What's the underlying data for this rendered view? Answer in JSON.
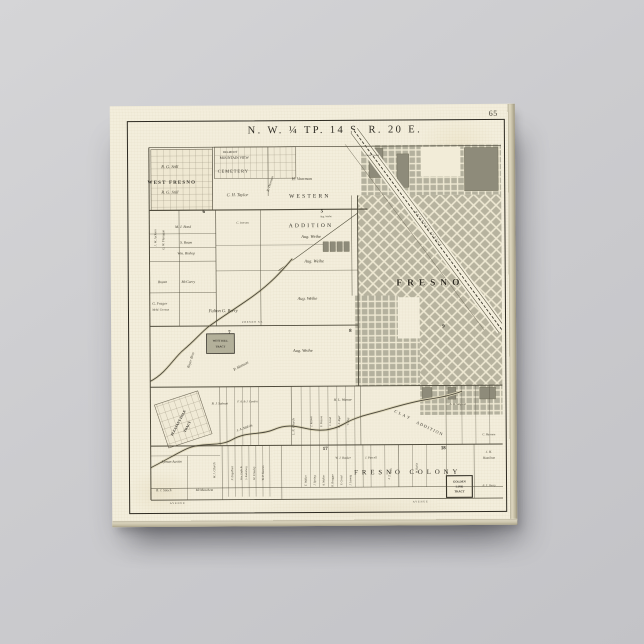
{
  "scene": {
    "background": "#cbcbce",
    "description": "Gallery-wrapped canvas print of an antique plat map of Fresno township hanging on a gray wall"
  },
  "canvas": {
    "page_number": "65"
  },
  "map": {
    "title": "N. W. ¼ TP. 14 S. R. 20 E.",
    "ink": "#35322a",
    "paper": "#f2ecd8",
    "block_fill": "#b7b4a2",
    "city_name": "FRESNO",
    "labels": [
      {
        "t": "WEST FRESNO",
        "x": 41,
        "y": 61,
        "s": 5,
        "ls": 1.2,
        "c": "b"
      },
      {
        "t": "R. G. Still",
        "x": 39,
        "y": 45,
        "s": 4.4,
        "c": "i"
      },
      {
        "t": "R. G. Still",
        "x": 39,
        "y": 71,
        "s": 4.4,
        "c": "i"
      },
      {
        "t": "BELMONT",
        "x": 100,
        "y": 30,
        "s": 3
      },
      {
        "t": "MOUNTAIN VIEW",
        "x": 104,
        "y": 36,
        "s": 3.6
      },
      {
        "t": "CEMETERY",
        "x": 103,
        "y": 50,
        "s": 4.4,
        "ls": 1
      },
      {
        "t": "C. H. Taylor",
        "x": 107,
        "y": 74,
        "s": 4.4,
        "c": "i"
      },
      {
        "t": "H. Voorman",
        "x": 172,
        "y": 58,
        "s": 4.2,
        "c": "i"
      },
      {
        "t": "R. Thurman",
        "x": 141,
        "y": 62,
        "s": 3.4,
        "r": -72,
        "c": "i"
      },
      {
        "t": "WESTERN",
        "x": 180,
        "y": 76,
        "s": 5.6,
        "ls": 2.2
      },
      {
        "t": "ADDITION",
        "x": 181,
        "y": 106,
        "s": 5.6,
        "ls": 2.2
      },
      {
        "t": "Aug. Weihe",
        "x": 181,
        "y": 117,
        "s": 4.4,
        "c": "i"
      },
      {
        "t": "Aug. Weihe",
        "x": 184,
        "y": 142,
        "s": 4.4,
        "c": "i"
      },
      {
        "t": "Aug. Weihe",
        "x": 177,
        "y": 180,
        "s": 4.4,
        "c": "i"
      },
      {
        "t": "Aug. Weihe",
        "x": 172,
        "y": 233,
        "s": 4.4,
        "c": "i"
      },
      {
        "t": "Aug. Weihe",
        "x": 196,
        "y": 96,
        "s": 2.6,
        "c": "i"
      },
      {
        "t": "FRESNO",
        "x": 301,
        "y": 166,
        "s": 9.5,
        "ls": 5,
        "c": "city"
      },
      {
        "t": "Grand Central",
        "x": 243,
        "y": 34,
        "s": 2.5
      },
      {
        "t": "M. J. Bond",
        "x": 52,
        "y": 106,
        "s": 3.7,
        "c": "i"
      },
      {
        "t": "S. Beam",
        "x": 55,
        "y": 122,
        "s": 3.7,
        "c": "i"
      },
      {
        "t": "Wm. Bishop",
        "x": 55,
        "y": 133,
        "s": 3.7,
        "c": "i"
      },
      {
        "t": "J. W. Jackson",
        "x": 25,
        "y": 116,
        "s": 3.2,
        "r": -90,
        "c": "i"
      },
      {
        "t": "G. W. Flanagan",
        "x": 33,
        "y": 118,
        "s": 3.2,
        "r": -90,
        "c": "i"
      },
      {
        "t": "C. Iversen",
        "x": 112,
        "y": 102,
        "s": 3,
        "c": "i"
      },
      {
        "t": "Royan",
        "x": 31,
        "y": 162,
        "s": 3.7,
        "c": "i"
      },
      {
        "t": "McGarry",
        "x": 57,
        "y": 162,
        "s": 3.7,
        "c": "i"
      },
      {
        "t": "G. Frager",
        "x": 28,
        "y": 184,
        "s": 3.7,
        "c": "i"
      },
      {
        "t": "McM. Corman",
        "x": 29,
        "y": 190,
        "s": 2.9,
        "c": "i"
      },
      {
        "t": "Fulton G. Berry",
        "x": 92,
        "y": 192,
        "s": 4.6,
        "c": "i"
      },
      {
        "t": "Royer Bros",
        "x": 60,
        "y": 241,
        "s": 3.7,
        "r": -72,
        "c": "i"
      },
      {
        "t": "P. Monson",
        "x": 110,
        "y": 248,
        "s": 4,
        "r": -28,
        "c": "i"
      },
      {
        "t": "WEST HILL",
        "x": 89,
        "y": 222,
        "s": 2.8,
        "c": "b"
      },
      {
        "t": "TRACT",
        "x": 89,
        "y": 228,
        "s": 2.8,
        "c": "b"
      },
      {
        "t": "FRESNO ST.",
        "x": 122,
        "y": 203,
        "s": 2.6,
        "ls": 0.8
      },
      {
        "t": "PLEASANT DALE",
        "x": 47,
        "y": 305,
        "s": 3.5,
        "r": -62,
        "c": "b"
      },
      {
        "t": "TRACT",
        "x": 56,
        "y": 309,
        "s": 3.5,
        "r": -62,
        "c": "b"
      },
      {
        "t": "B. J. Salmon",
        "x": 88,
        "y": 286,
        "s": 3.3,
        "c": "i"
      },
      {
        "t": "F. A. & J. Condra",
        "x": 116,
        "y": 284,
        "s": 2.9,
        "c": "i"
      },
      {
        "t": "J. A. Malvin",
        "x": 113,
        "y": 311,
        "s": 3.5,
        "r": -20,
        "c": "i"
      },
      {
        "t": "L. N. Church",
        "x": 163,
        "y": 309,
        "s": 3.3,
        "r": -90,
        "c": "i"
      },
      {
        "t": "Lyman Austin",
        "x": 39,
        "y": 345,
        "s": 3.7,
        "c": "i"
      },
      {
        "t": "B. J. Stioch",
        "x": 31,
        "y": 374,
        "s": 3.4,
        "c": "i"
      },
      {
        "t": "McMeachem",
        "x": 72,
        "y": 374,
        "s": 3.4,
        "c": "i"
      },
      {
        "t": "W. J. Church",
        "x": 83,
        "y": 353,
        "s": 3.2,
        "r": -90,
        "c": "i"
      },
      {
        "t": "F. Engelbert",
        "x": 101,
        "y": 356,
        "s": 3,
        "r": -90,
        "c": "i"
      },
      {
        "t": "Wm. Engle &",
        "x": 110,
        "y": 356,
        "s": 2.6,
        "r": -90,
        "c": "i"
      },
      {
        "t": "S. Rodenberg",
        "x": 115,
        "y": 356,
        "s": 2.6,
        "r": -90,
        "c": "i"
      },
      {
        "t": "H. Crowley",
        "x": 123,
        "y": 356,
        "s": 3,
        "r": -90,
        "c": "i"
      },
      {
        "t": "W. P. Kearns",
        "x": 132,
        "y": 356,
        "s": 3,
        "r": -90,
        "c": "i"
      },
      {
        "t": "H. L. Warner",
        "x": 212,
        "y": 283,
        "s": 3.5,
        "c": "i"
      },
      {
        "t": "J. Keown",
        "x": 181,
        "y": 304,
        "s": 2.9,
        "r": -90,
        "c": "i"
      },
      {
        "t": "F. Pascoe",
        "x": 191,
        "y": 304,
        "s": 2.9,
        "r": -90,
        "c": "i"
      },
      {
        "t": "J. Lovel",
        "x": 200,
        "y": 304,
        "s": 2.9,
        "r": -90,
        "c": "i"
      },
      {
        "t": "B. F. Alger",
        "x": 209,
        "y": 304,
        "s": 2.9,
        "r": -90,
        "c": "i"
      },
      {
        "t": "V. Clay",
        "x": 218,
        "y": 304,
        "s": 2.9,
        "r": -90,
        "c": "i"
      },
      {
        "t": "CLAY",
        "x": 272,
        "y": 299,
        "s": 4.2,
        "r": 26,
        "ls": 2
      },
      {
        "t": "ADDITION",
        "x": 299,
        "y": 313,
        "s": 4.2,
        "r": 26,
        "ls": 1.2
      },
      {
        "t": "A. H. Simpson",
        "x": 328,
        "y": 288,
        "s": 2.9,
        "c": "i"
      },
      {
        "t": "C. Harmon",
        "x": 359,
        "y": 319,
        "s": 2.9,
        "c": "i"
      },
      {
        "t": "FRESNO COLONY",
        "x": 277,
        "y": 358,
        "s": 6.8,
        "ls": 4.5,
        "c": "colony"
      },
      {
        "t": "J. H.",
        "x": 359,
        "y": 337,
        "s": 3.3,
        "c": "i"
      },
      {
        "t": "Hamilton",
        "x": 359,
        "y": 343,
        "s": 3.3,
        "c": "i"
      },
      {
        "t": "GOLDEN",
        "x": 329,
        "y": 367,
        "s": 3,
        "c": "b"
      },
      {
        "t": "LINK",
        "x": 329,
        "y": 372,
        "s": 3,
        "c": "b"
      },
      {
        "t": "TRACT",
        "x": 329,
        "y": 377,
        "s": 3,
        "c": "b"
      },
      {
        "t": "B. S. Derry",
        "x": 359,
        "y": 371,
        "s": 3,
        "c": "i"
      },
      {
        "t": "T. Walker",
        "x": 175,
        "y": 364,
        "s": 2.9,
        "r": -90,
        "c": "i"
      },
      {
        "t": "J. Spring",
        "x": 184,
        "y": 364,
        "s": 2.9,
        "r": -90,
        "c": "i"
      },
      {
        "t": "A. Walker",
        "x": 193,
        "y": 364,
        "s": 2.9,
        "r": -90,
        "c": "i"
      },
      {
        "t": "R. Bragger",
        "x": 202,
        "y": 364,
        "s": 2.9,
        "r": -90,
        "c": "i"
      },
      {
        "t": "F. Creed",
        "x": 211,
        "y": 364,
        "s": 2.9,
        "r": -90,
        "c": "i"
      },
      {
        "t": "J. Lannig",
        "x": 220,
        "y": 364,
        "s": 2.9,
        "r": -90,
        "c": "i"
      },
      {
        "t": "W. J. Booker",
        "x": 212,
        "y": 342,
        "s": 3.1,
        "c": "i"
      },
      {
        "t": "J. Purcell",
        "x": 240,
        "y": 342,
        "s": 3.1,
        "c": "i"
      },
      {
        "t": "J. T. Lyon",
        "x": 260,
        "y": 358,
        "s": 3,
        "r": -78,
        "c": "i"
      },
      {
        "t": "W. Burke",
        "x": 287,
        "y": 352,
        "s": 2.9,
        "r": -90,
        "c": "i"
      },
      {
        "t": "RAILROAD AVENUE",
        "x": 299,
        "y": 109,
        "s": 2.8,
        "r": 54,
        "ls": 1.2
      },
      {
        "t": "AVENUE",
        "x": 45,
        "y": 387,
        "s": 2.5,
        "ls": 1
      },
      {
        "t": "AVENUE",
        "x": 290,
        "y": 387,
        "s": 2.5,
        "ls": 1
      },
      {
        "t": "6",
        "x": 73,
        "y": 91,
        "s": 5,
        "c": "sec"
      },
      {
        "t": "5",
        "x": 192,
        "y": 91,
        "s": 5,
        "c": "sec"
      },
      {
        "t": "7",
        "x": 98,
        "y": 214,
        "s": 5,
        "c": "sec"
      },
      {
        "t": "8",
        "x": 220,
        "y": 213,
        "s": 5,
        "c": "sec"
      },
      {
        "t": "9",
        "x": 314,
        "y": 209,
        "s": 5,
        "c": "sec"
      },
      {
        "t": "17",
        "x": 194,
        "y": 333,
        "s": 5,
        "c": "sec"
      },
      {
        "t": "18",
        "x": 313,
        "y": 333,
        "s": 5,
        "c": "sec"
      }
    ],
    "rects": [
      {
        "x": 20,
        "y": 26,
        "w": 62,
        "h": 62,
        "c": "lots2"
      },
      {
        "x": 84,
        "y": 24,
        "w": 82,
        "h": 32,
        "c": "lots"
      },
      {
        "x": 232,
        "y": 23,
        "w": 141,
        "h": 51,
        "c": "axis"
      },
      {
        "x": 240,
        "y": 26,
        "w": 14,
        "h": 30,
        "c": "dark"
      },
      {
        "x": 268,
        "y": 32,
        "w": 12,
        "h": 34,
        "c": "dark"
      },
      {
        "x": 336,
        "y": 26,
        "w": 34,
        "h": 44,
        "c": "dark"
      },
      {
        "x": 292,
        "y": 25,
        "w": 40,
        "h": 30,
        "c": "paper"
      },
      {
        "x": 228,
        "y": 74,
        "w": 145,
        "h": 104,
        "c": "diag"
      },
      {
        "x": 290,
        "y": 178,
        "w": 83,
        "h": 90,
        "c": "diag"
      },
      {
        "x": 225,
        "y": 176,
        "w": 43,
        "h": 44,
        "c": "axis"
      },
      {
        "x": 225,
        "y": 220,
        "w": 65,
        "h": 48,
        "c": "axis"
      },
      {
        "x": 290,
        "y": 268,
        "w": 83,
        "h": 30,
        "c": "axis"
      },
      {
        "x": 292,
        "y": 270,
        "w": 10,
        "h": 12,
        "c": "dark"
      },
      {
        "x": 318,
        "y": 270,
        "w": 8,
        "h": 12,
        "c": "dark"
      },
      {
        "x": 350,
        "y": 270,
        "w": 16,
        "h": 12,
        "c": "dark"
      },
      {
        "x": 193,
        "y": 121,
        "w": 5.5,
        "h": 10,
        "c": "dark"
      },
      {
        "x": 200,
        "y": 121,
        "w": 5.5,
        "h": 10,
        "c": "dark"
      },
      {
        "x": 207,
        "y": 121,
        "w": 5.5,
        "h": 10,
        "c": "dark"
      },
      {
        "x": 214,
        "y": 121,
        "w": 5.5,
        "h": 10,
        "c": "dark"
      },
      {
        "x": 75,
        "y": 214,
        "w": 28,
        "h": 20,
        "c": "boxdark"
      },
      {
        "x": 28,
        "y": 278,
        "w": 46,
        "h": 46,
        "c": "lots",
        "rot": -18
      },
      {
        "x": 316,
        "y": 360,
        "w": 26,
        "h": 22,
        "c": "box2"
      }
    ],
    "paths": [
      {
        "d": "M225,8 L373,212",
        "c": "rrband"
      },
      {
        "d": "M228.2,5.6 L376.2,209.6",
        "c": "rredge"
      },
      {
        "d": "M221.8,10.4 L369.8,214.4",
        "c": "rredge"
      },
      {
        "d": "M225,8 L373,212",
        "c": "rrtrack"
      },
      {
        "d": "M216,22 L355,212",
        "c": "thin"
      },
      {
        "d": "M148,150 L228,92",
        "c": "thin2"
      },
      {
        "d": "M18,262 C34,254 42,238 52,230 C64,220 70,212 78,206 C92,196 108,186 122,176 C140,163 150,152 162,138",
        "c": "riverglow"
      },
      {
        "d": "M18,262 C34,254 42,238 52,230 C64,220 70,212 78,206 C92,196 108,186 122,176 C140,163 150,152 162,138",
        "c": "river"
      },
      {
        "d": "M18,350 C30,344 40,338 52,332 C70,323 86,330 100,322 C116,313 128,318 142,312 C158,305 168,310 180,312 C192,314 204,312 214,306 C228,298 244,296 256,292 C270,288 284,284 298,282 C312,280 322,278 332,274",
        "c": "riverglow"
      },
      {
        "d": "M18,350 C30,344 40,338 52,332 C70,323 86,330 100,322 C116,313 128,318 142,312 C158,305 168,310 180,312 C192,314 204,312 214,306 C228,298 244,296 256,292 C270,288 284,284 298,282 C312,280 322,278 332,274",
        "c": "river"
      }
    ],
    "lines": [
      [
        18,
        24,
        373,
        24,
        0.7
      ],
      [
        18,
        24,
        18,
        383,
        1.0
      ],
      [
        18,
        383,
        373,
        383,
        0.8
      ],
      [
        18,
        88,
        238,
        88,
        1.1
      ],
      [
        18,
        206,
        228,
        206,
        1.0
      ],
      [
        18,
        268,
        373,
        268,
        1.0
      ],
      [
        18,
        328,
        373,
        328,
        1.0
      ],
      [
        18,
        371,
        373,
        371,
        0.5
      ],
      [
        82,
        24,
        82,
        88,
        0.5
      ],
      [
        85,
        88,
        85,
        206,
        0.6
      ],
      [
        48,
        88,
        48,
        206,
        0.45
      ],
      [
        130,
        88,
        130,
        206,
        0.45
      ],
      [
        138,
        24,
        138,
        74,
        0.45
      ],
      [
        222,
        74,
        222,
        176,
        0.45
      ],
      [
        228,
        74,
        228,
        268,
        0.9
      ],
      [
        18,
        112,
        85,
        112,
        0.35
      ],
      [
        18,
        126,
        85,
        126,
        0.35
      ],
      [
        18,
        140,
        85,
        140,
        0.4
      ],
      [
        18,
        172,
        85,
        172,
        0.4
      ],
      [
        85,
        150,
        228,
        150,
        0.35
      ],
      [
        85,
        124,
        193,
        124,
        0.3
      ],
      [
        18,
        338,
        88,
        338,
        0.3
      ],
      [
        55,
        338,
        55,
        383,
        0.35
      ],
      [
        160,
        268,
        160,
        328,
        0.5
      ],
      [
        230,
        268,
        230,
        328,
        0.45
      ],
      [
        316,
        268,
        316,
        328,
        0.4
      ],
      [
        344,
        328,
        344,
        383,
        0.4
      ],
      [
        316,
        328,
        316,
        383,
        0.4
      ],
      [
        268,
        328,
        268,
        371,
        0.35
      ],
      [
        232,
        328,
        232,
        371,
        0.35
      ],
      [
        150,
        328,
        150,
        383,
        0.4
      ],
      [
        90,
        328,
        90,
        383,
        0.4
      ],
      [
        88,
        268,
        88,
        328,
        0.4
      ]
    ],
    "bands": [
      {
        "y1": 268,
        "y2": 328,
        "w": 0.3,
        "xs": [
          95,
          103,
          111,
          119,
          127,
          170,
          179,
          188,
          197,
          206,
          215,
          224,
          332,
          346,
          360
        ]
      },
      {
        "y1": 328,
        "y2": 380,
        "w": 0.3,
        "xs": [
          96,
          103,
          110,
          117,
          124,
          131,
          138
        ]
      },
      {
        "y1": 328,
        "y2": 371,
        "w": 0.3,
        "xs": [
          170,
          179,
          188,
          197,
          206,
          215,
          224,
          240,
          254,
          268,
          282,
          296
        ]
      }
    ]
  }
}
